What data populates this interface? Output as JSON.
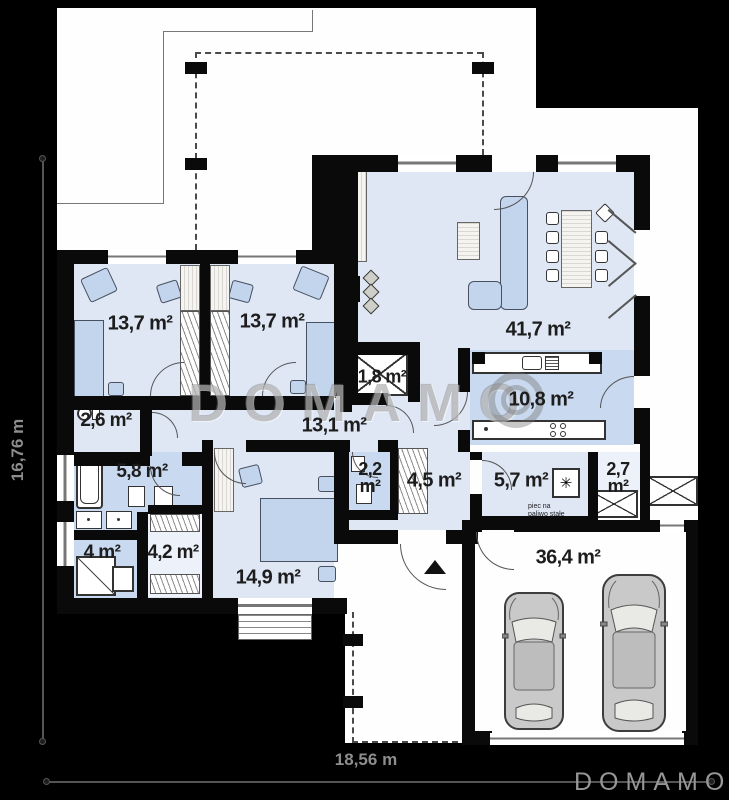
{
  "watermark": {
    "text": "DOMAMO"
  },
  "logo": {
    "text": "DOMAMO"
  },
  "dimensions": {
    "height_label": "16,76 m",
    "width_label": "18,56 m"
  },
  "rooms": {
    "bedroom1": {
      "name": "bedroom",
      "area": "13,7 m²"
    },
    "bedroom2": {
      "name": "bedroom",
      "area": "13,7 m²"
    },
    "living_room": {
      "name": "living room",
      "area": "41,7 m²"
    },
    "closet": {
      "name": "closet",
      "area": "1,8 m²"
    },
    "hallway": {
      "name": "hallway",
      "area": "13,1 m²"
    },
    "kitchen": {
      "name": "kitchen",
      "area": "10,8 m²"
    },
    "wc": {
      "name": "wc",
      "area": "2,6 m²"
    },
    "bathroom": {
      "name": "bathroom",
      "area": "5,8 m²"
    },
    "wc2": {
      "name": "wc",
      "area": "2,2 m²"
    },
    "entry": {
      "name": "entry hall",
      "area": "4,5 m²"
    },
    "boiler_room": {
      "name": "boiler room",
      "area": "5,7 m²"
    },
    "pantry": {
      "name": "pantry",
      "area": "2,7 m²"
    },
    "shower_room": {
      "name": "shower room",
      "area": "4 m²"
    },
    "wardrobe": {
      "name": "wardrobe",
      "area": "4,2 m²"
    },
    "bedroom3": {
      "name": "bedroom",
      "area": "14,9 m²"
    },
    "garage": {
      "name": "garage",
      "area": "36,4 m²"
    }
  },
  "annotations": {
    "boiler_note_line1": "piec na",
    "boiler_note_line2": "paliwo stałe"
  },
  "icons": {
    "boiler_stove": "✳"
  },
  "colors": {
    "wall": "#0a0a0a",
    "room_fill": "#dfe7f5",
    "wet_room_fill": "#c9d9ef",
    "background": "#000000",
    "plot": "#fefefe"
  }
}
